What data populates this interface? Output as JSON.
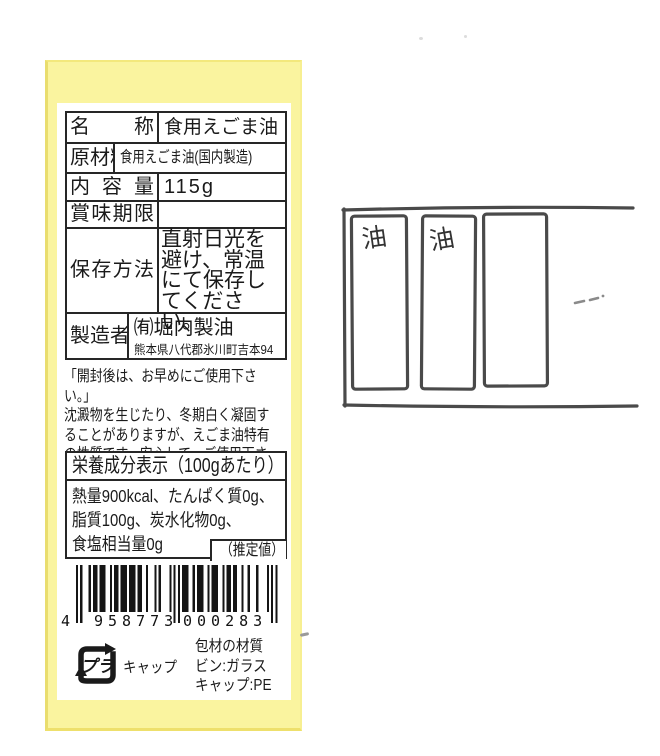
{
  "colors": {
    "label_yellow": "#faf49f",
    "ink": "#1a1a1a",
    "sketch_stroke": "#4a4a4a"
  },
  "label": {
    "table": {
      "rows": [
        {
          "label": "名称",
          "value": "食用えごま油"
        },
        {
          "label": "原材料名",
          "value": "食用えごま油(国内製造)"
        },
        {
          "label": "内容量",
          "value": "115g"
        },
        {
          "label": "賞味期限",
          "value": ""
        },
        {
          "label": "保存方法",
          "value": "直射日光を避け、常温にて保存してください。"
        },
        {
          "label": "製造者",
          "value": "㈲堀内製油",
          "address": "熊本県八代郡氷川町吉本94"
        }
      ]
    },
    "usage_note": "「開封後は、お早めにご使用下さい。」\n沈澱物を生じたり、冬期白く凝固す\nることがありますが、えごま油特有\nの性質です。安心して、ご使用下さい。",
    "nutrition": {
      "title": "栄養成分表示（100gあたり）",
      "body": "熱量900kcal、たんぱく質0g、\n脂質100g、炭水化物0g、\n食塩相当量0g",
      "estimate": "（推定値）"
    },
    "barcode": {
      "value": "4958773000283",
      "first_digit": "4",
      "left_digits": "958773",
      "right_digits": "000283"
    },
    "packaging": {
      "recycle_mark": "プラ",
      "cap_label": "キャップ",
      "material_info": "包材の材質\nビン:ガラス\nキャップ:PE"
    }
  },
  "sketch": {
    "slot1": "油",
    "slot2": "油"
  }
}
